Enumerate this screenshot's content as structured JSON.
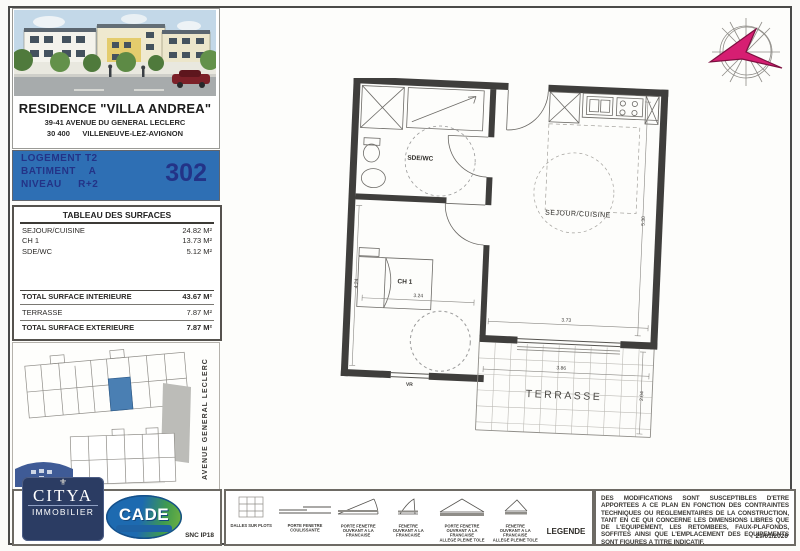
{
  "colors": {
    "banner_blue": "#2e6fb4",
    "banner_text": "#233387",
    "citya_navy": "#2b3c63",
    "cade_blue": "#1d6ab0",
    "compass_pink": "#d61e72",
    "site_unit_highlight": "#4a7fb3"
  },
  "header": {
    "residence_name": "RESIDENCE \"VILLA ANDREA\"",
    "address_line1": "39-41 AVENUE DU GENERAL LECLERC",
    "address_line2": "30 400      VILLENEUVE-LEZ-AVIGNON"
  },
  "unit": {
    "logement": "LOGEMENT T2",
    "batiment": "BATIMENT    A",
    "niveau": "NIVEAU     R+2",
    "numero": "302"
  },
  "surfaces": {
    "title": "TABLEAU DES SURFACES",
    "rows": [
      {
        "label": "SEJOUR/CUISINE",
        "value": "24.82 M²"
      },
      {
        "label": "CH 1",
        "value": "13.73 M²"
      },
      {
        "label": "SDE/WC",
        "value": "5.12 M²"
      }
    ],
    "total_interieure_label": "TOTAL SURFACE INTERIEURE",
    "total_interieure_value": "43.67 M²",
    "terrasse_label": "TERRASSE",
    "terrasse_value": "7.87 M²",
    "total_exterieure_label": "TOTAL SURFACE EXTERIEURE",
    "total_exterieure_value": "7.87 M²"
  },
  "site_plan": {
    "street": "AVENUE GENERAL LECLERC"
  },
  "branding": {
    "citya_name": "CITYA",
    "citya_sub": "IMMOBILIER",
    "citya_crest": "⚜",
    "cade_name": "CADE",
    "ref": "SNC IP18"
  },
  "floor_plan": {
    "rooms": {
      "sde_wc": "SDE/WC",
      "sejour_cuisine": "SEJOUR/CUISINE",
      "ch1": "CH 1",
      "terrasse": "TERRASSE"
    },
    "dims": {
      "ch1_width": "3.24",
      "ch1_depth": "4.24",
      "sejour_depth": "5.30",
      "sejour_width": "3.73",
      "terrasse_width": "3.86",
      "terrasse_depth": "2.04"
    },
    "window_label": "VR"
  },
  "legend": {
    "title": "LEGENDE",
    "items": [
      {
        "label": "DALLES SUR PLOTS"
      },
      {
        "label": "PORTE FENETRE\nCOULISSANTE"
      },
      {
        "label": "PORTE FENETRE\nOUVRANT A LA FRANCAISE"
      },
      {
        "label": "FENETRE\nOUVRANT A LA FRANCAISE"
      },
      {
        "label": "PORTE FENETRE\nOUVRANT A LA FRANCAISE\nALLEGE PLEINE TOLE"
      },
      {
        "label": "FENETRE\nOUVRANT A LA FRANCAISE\nALLEGE PLEINE TOLE"
      }
    ]
  },
  "disclaimer": {
    "text": "DES MODIFICATIONS SONT SUSCEPTIBLES D'ETRE APPORTEES A CE PLAN EN FONCTION DES CONTRAINTES TECHNIQUES OU REGLEMENTAIRES DE LA CONSTRUCTION, TANT EN CE QUI CONCERNE LES DIMENSIONS LIBRES QUE DE L'EQUIPEMENT, LES RETOMBEES, FAUX-PLAFONDS, SOFFITES AINSI QUE L'EMPLACEMENT DES EQUIPEMENTS SONT FIGURES A TITRE INDICATIF.",
    "date": "29/01/2020"
  }
}
